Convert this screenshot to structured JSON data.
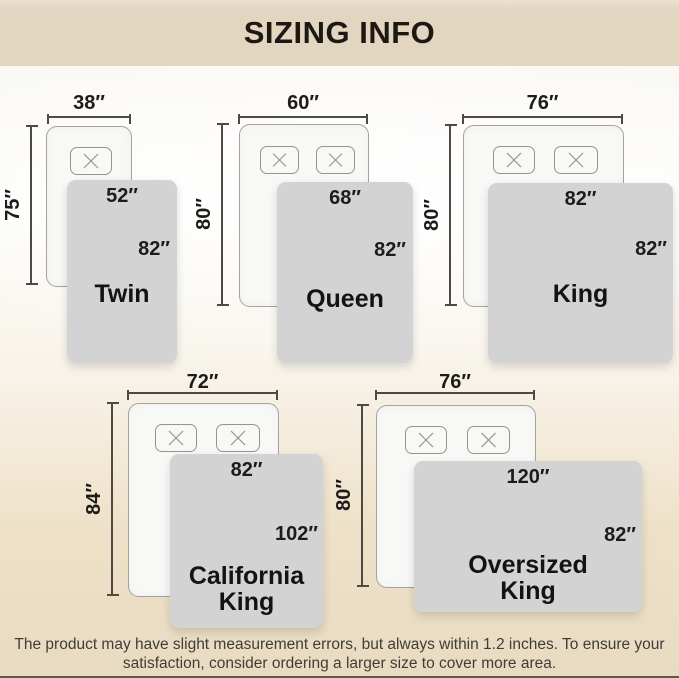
{
  "header": {
    "title": "SIZING INFO"
  },
  "diagrams": [
    {
      "name": "Twin",
      "bed_width": "38″",
      "bed_length": "75″",
      "blanket_width": "52″",
      "blanket_length": "82″"
    },
    {
      "name": "Queen",
      "bed_width": "60″",
      "bed_length": "80″",
      "blanket_width": "68″",
      "blanket_length": "82″"
    },
    {
      "name": "King",
      "bed_width": "76″",
      "bed_length": "80″",
      "blanket_width": "82″",
      "blanket_length": "82″"
    },
    {
      "name": "California King",
      "bed_width": "72″",
      "bed_length": "84″",
      "blanket_width": "82″",
      "blanket_length": "102″"
    },
    {
      "name": "Oversized King",
      "bed_width": "76″",
      "bed_length": "80″",
      "blanket_width": "120″",
      "blanket_length": "82″"
    }
  ],
  "footer": {
    "line1": "The product may have slight measurement errors, but always within 1.2 inches. To ensure your",
    "line2": "satisfaction, consider ordering a larger size to cover more area."
  },
  "colors": {
    "header_bg": "#e3d6c1",
    "title_text": "#1e1812",
    "bed_fill": "#f8f8f6",
    "bed_border": "#a6a39d",
    "blanket_fill": "#d3d3d3",
    "dimension_line": "#4d4a45",
    "label_text": "#1d1c1a",
    "footer_text": "#403c36",
    "background_bottom": "#e8dbc2"
  }
}
